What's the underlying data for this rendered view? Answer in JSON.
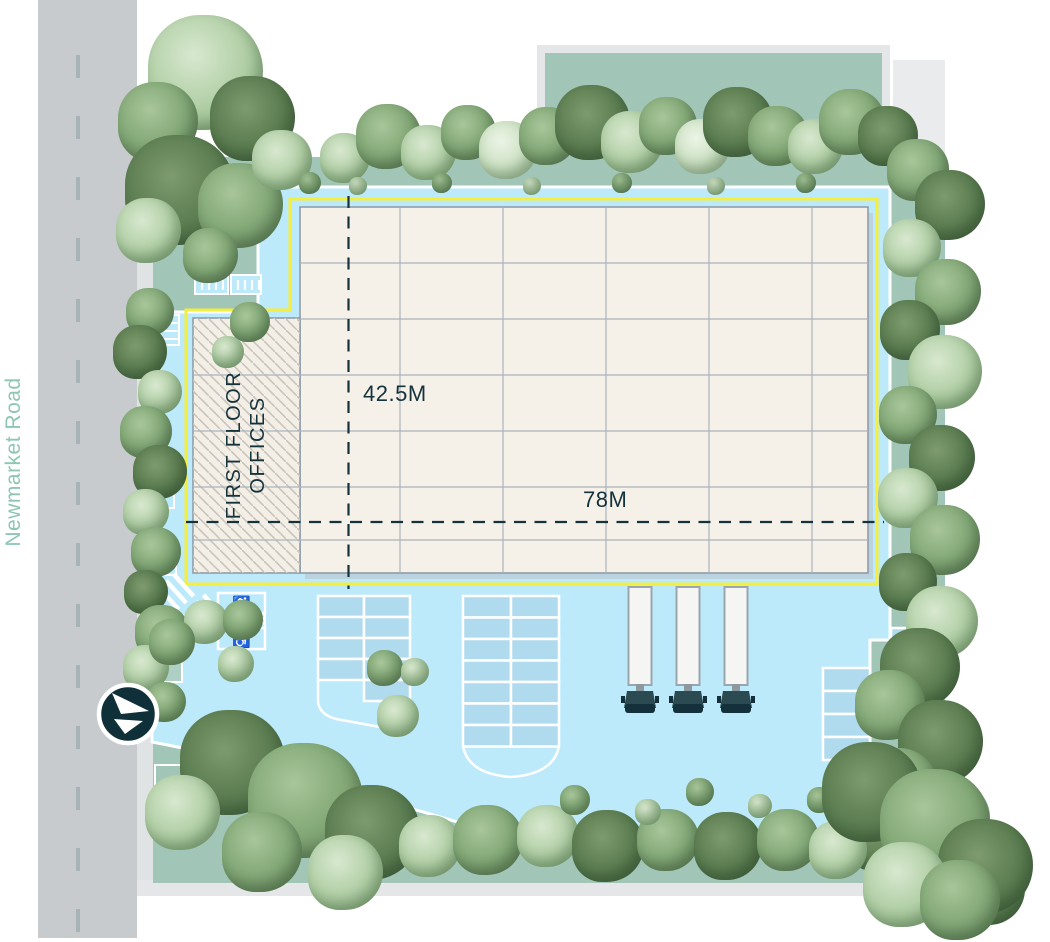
{
  "road": {
    "name": "Newmarket Road",
    "label_color": "#8dc6b1",
    "dashes": {
      "x": 76,
      "start": 55,
      "step": 61,
      "len": 23,
      "count": 15
    }
  },
  "dimensions": {
    "depth_label": "42.5M",
    "width_label": "78M"
  },
  "building": {
    "label_line1": "FIRST FLOOR",
    "label_line2": "OFFICES",
    "grid": {
      "verticals": [
        400,
        503,
        606,
        709,
        812
      ],
      "rows_main": [
        263,
        319
      ],
      "rows_full": [
        375,
        431,
        487,
        540
      ],
      "top": 207,
      "bottom": 573,
      "left_main": 300,
      "left_wing": 193,
      "right": 868
    }
  },
  "icons": {
    "wheelchair": "♿",
    "north_arrow": "compass-arrow"
  },
  "colors": {
    "road": "#c7cbce",
    "hardstanding": "#bceafa",
    "landscape": "#a1c6b8",
    "building": "#f6f1e8",
    "boundary_yellow": "#f4ee3e",
    "ink": "#14323c",
    "bay_fill": "#b0dbee",
    "gray_edge": "#e4e6e7"
  },
  "trucks": {
    "count": 3,
    "x": [
      640,
      688,
      736
    ]
  },
  "parking": {
    "blocks": [
      {
        "x": 318,
        "y": 596,
        "cw": 46,
        "rh": 21,
        "colRows": [
          4,
          5
        ]
      },
      {
        "x": 463,
        "y": 596,
        "cw": 48,
        "rh": 21.5,
        "colRows": [
          7,
          7
        ]
      },
      {
        "x": 823,
        "y": 668,
        "cw": 47,
        "rh": 23,
        "colRows": [
          4
        ]
      },
      {
        "x": 891,
        "y": 628,
        "cw": 45,
        "rh": 20,
        "colRows": [
          2
        ]
      }
    ]
  },
  "trees": [
    [
      205,
      72,
      115,
      "light"
    ],
    [
      158,
      122,
      80,
      "mid"
    ],
    [
      252,
      118,
      85,
      "dark"
    ],
    [
      180,
      190,
      110,
      "dark"
    ],
    [
      240,
      205,
      85,
      "mid"
    ],
    [
      148,
      230,
      65,
      "light"
    ],
    [
      282,
      160,
      60,
      "light"
    ],
    [
      210,
      255,
      55,
      "mid"
    ],
    [
      345,
      158,
      50,
      "light"
    ],
    [
      388,
      136,
      65,
      "mid"
    ],
    [
      428,
      152,
      55,
      "light"
    ],
    [
      468,
      132,
      55,
      "mid"
    ],
    [
      508,
      150,
      58,
      "pale"
    ],
    [
      548,
      136,
      58,
      "mid"
    ],
    [
      592,
      122,
      75,
      "dark"
    ],
    [
      632,
      142,
      62,
      "light"
    ],
    [
      668,
      126,
      58,
      "mid"
    ],
    [
      702,
      146,
      55,
      "pale"
    ],
    [
      738,
      122,
      70,
      "dark"
    ],
    [
      778,
      136,
      60,
      "mid"
    ],
    [
      815,
      146,
      55,
      "light"
    ],
    [
      852,
      122,
      66,
      "mid"
    ],
    [
      888,
      136,
      60,
      "dark"
    ],
    [
      310,
      183,
      22,
      "mid"
    ],
    [
      358,
      186,
      18,
      "light"
    ],
    [
      442,
      183,
      20,
      "mid"
    ],
    [
      532,
      186,
      18,
      "light"
    ],
    [
      622,
      183,
      20,
      "mid"
    ],
    [
      716,
      186,
      18,
      "light"
    ],
    [
      806,
      183,
      20,
      "mid"
    ],
    [
      918,
      170,
      62,
      "mid"
    ],
    [
      950,
      205,
      70,
      "dark"
    ],
    [
      912,
      248,
      58,
      "light"
    ],
    [
      948,
      292,
      66,
      "mid"
    ],
    [
      910,
      330,
      60,
      "dark"
    ],
    [
      945,
      372,
      74,
      "light"
    ],
    [
      908,
      415,
      58,
      "mid"
    ],
    [
      942,
      458,
      66,
      "dark"
    ],
    [
      908,
      498,
      60,
      "light"
    ],
    [
      945,
      540,
      70,
      "mid"
    ],
    [
      908,
      582,
      58,
      "dark"
    ],
    [
      942,
      622,
      72,
      "light"
    ],
    [
      920,
      668,
      80,
      "dark"
    ],
    [
      890,
      705,
      70,
      "mid"
    ],
    [
      940,
      742,
      85,
      "dark"
    ],
    [
      898,
      788,
      80,
      "mid"
    ],
    [
      955,
      818,
      70,
      "light"
    ],
    [
      878,
      838,
      66,
      "dark"
    ],
    [
      940,
      872,
      80,
      "mid"
    ],
    [
      990,
      890,
      70,
      "dark"
    ],
    [
      150,
      312,
      48,
      "mid"
    ],
    [
      140,
      352,
      54,
      "dark"
    ],
    [
      160,
      392,
      44,
      "light"
    ],
    [
      146,
      432,
      52,
      "mid"
    ],
    [
      160,
      472,
      54,
      "dark"
    ],
    [
      146,
      512,
      46,
      "light"
    ],
    [
      156,
      552,
      50,
      "mid"
    ],
    [
      146,
      592,
      44,
      "dark"
    ],
    [
      162,
      632,
      54,
      "mid"
    ],
    [
      146,
      668,
      46,
      "light"
    ],
    [
      166,
      702,
      40,
      "mid"
    ],
    [
      250,
      322,
      40,
      "mid"
    ],
    [
      228,
      352,
      32,
      "light"
    ],
    [
      206,
      622,
      44,
      "light"
    ],
    [
      243,
      620,
      40,
      "mid"
    ],
    [
      236,
      664,
      36,
      "light"
    ],
    [
      172,
      642,
      46,
      "mid"
    ],
    [
      385,
      668,
      36,
      "mid"
    ],
    [
      415,
      672,
      28,
      "light"
    ],
    [
      398,
      716,
      42,
      "light"
    ],
    [
      232,
      762,
      105,
      "dark"
    ],
    [
      305,
      800,
      115,
      "mid"
    ],
    [
      372,
      832,
      95,
      "dark"
    ],
    [
      182,
      812,
      75,
      "light"
    ],
    [
      262,
      852,
      80,
      "mid"
    ],
    [
      345,
      872,
      75,
      "light"
    ],
    [
      430,
      846,
      62,
      "light"
    ],
    [
      488,
      840,
      70,
      "mid"
    ],
    [
      548,
      836,
      62,
      "light"
    ],
    [
      608,
      846,
      72,
      "dark"
    ],
    [
      668,
      840,
      62,
      "mid"
    ],
    [
      728,
      846,
      68,
      "dark"
    ],
    [
      788,
      840,
      62,
      "mid"
    ],
    [
      838,
      850,
      58,
      "light"
    ],
    [
      575,
      800,
      30,
      "mid"
    ],
    [
      648,
      812,
      26,
      "light"
    ],
    [
      700,
      792,
      28,
      "mid"
    ],
    [
      760,
      806,
      24,
      "light"
    ],
    [
      820,
      800,
      26,
      "mid"
    ],
    [
      872,
      792,
      100,
      "dark"
    ],
    [
      935,
      824,
      110,
      "mid"
    ],
    [
      985,
      866,
      95,
      "dark"
    ],
    [
      905,
      884,
      85,
      "light"
    ],
    [
      960,
      900,
      80,
      "mid"
    ]
  ]
}
